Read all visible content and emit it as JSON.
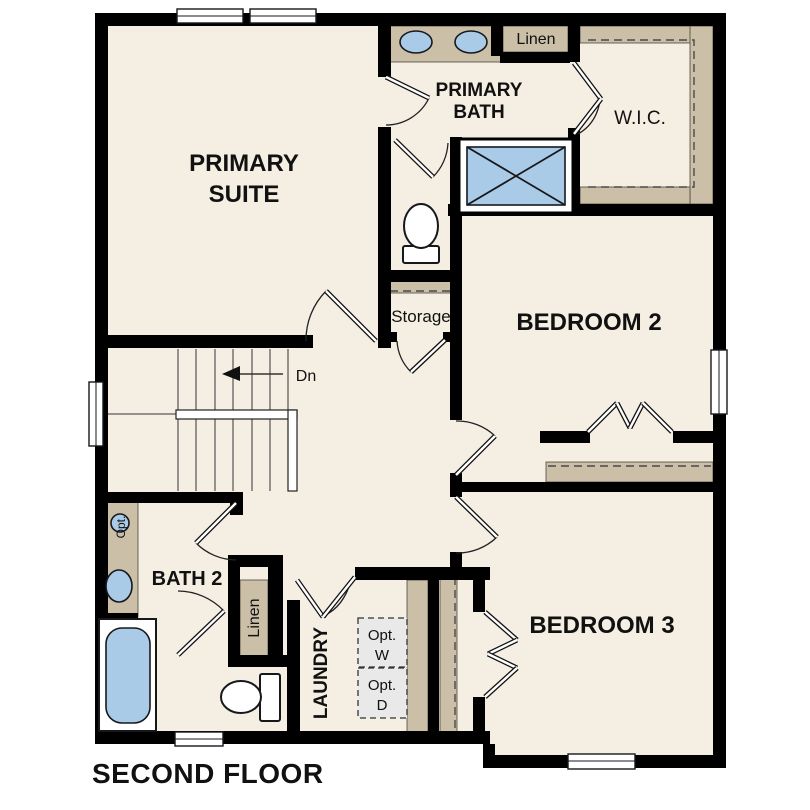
{
  "title": "SECOND FLOOR",
  "colors": {
    "floor": "#f5eee3",
    "casework_tan": "#cbbfa8",
    "fixture_blue": "#aacbe8",
    "wall_black": "#000000",
    "optional_gray": "#e9e9e9",
    "background": "#ffffff"
  },
  "labels": {
    "primary_suite": {
      "line1": "PRIMARY",
      "line2": "SUITE"
    },
    "primary_bath": {
      "line1": "PRIMARY",
      "line2": "BATH"
    },
    "linen_top": "Linen",
    "wic": "W.I.C.",
    "bedroom2": "BEDROOM 2",
    "storage": "Storage",
    "stair_direction": "Dn",
    "bath2": "BATH 2",
    "opt_fixture": "Opt.",
    "linen_lower": "Linen",
    "laundry": "LAUNDRY",
    "opt_washer": {
      "line1": "Opt.",
      "line2": "W"
    },
    "opt_dryer": {
      "line1": "Opt.",
      "line2": "D"
    },
    "bedroom3": "BEDROOM 3"
  }
}
